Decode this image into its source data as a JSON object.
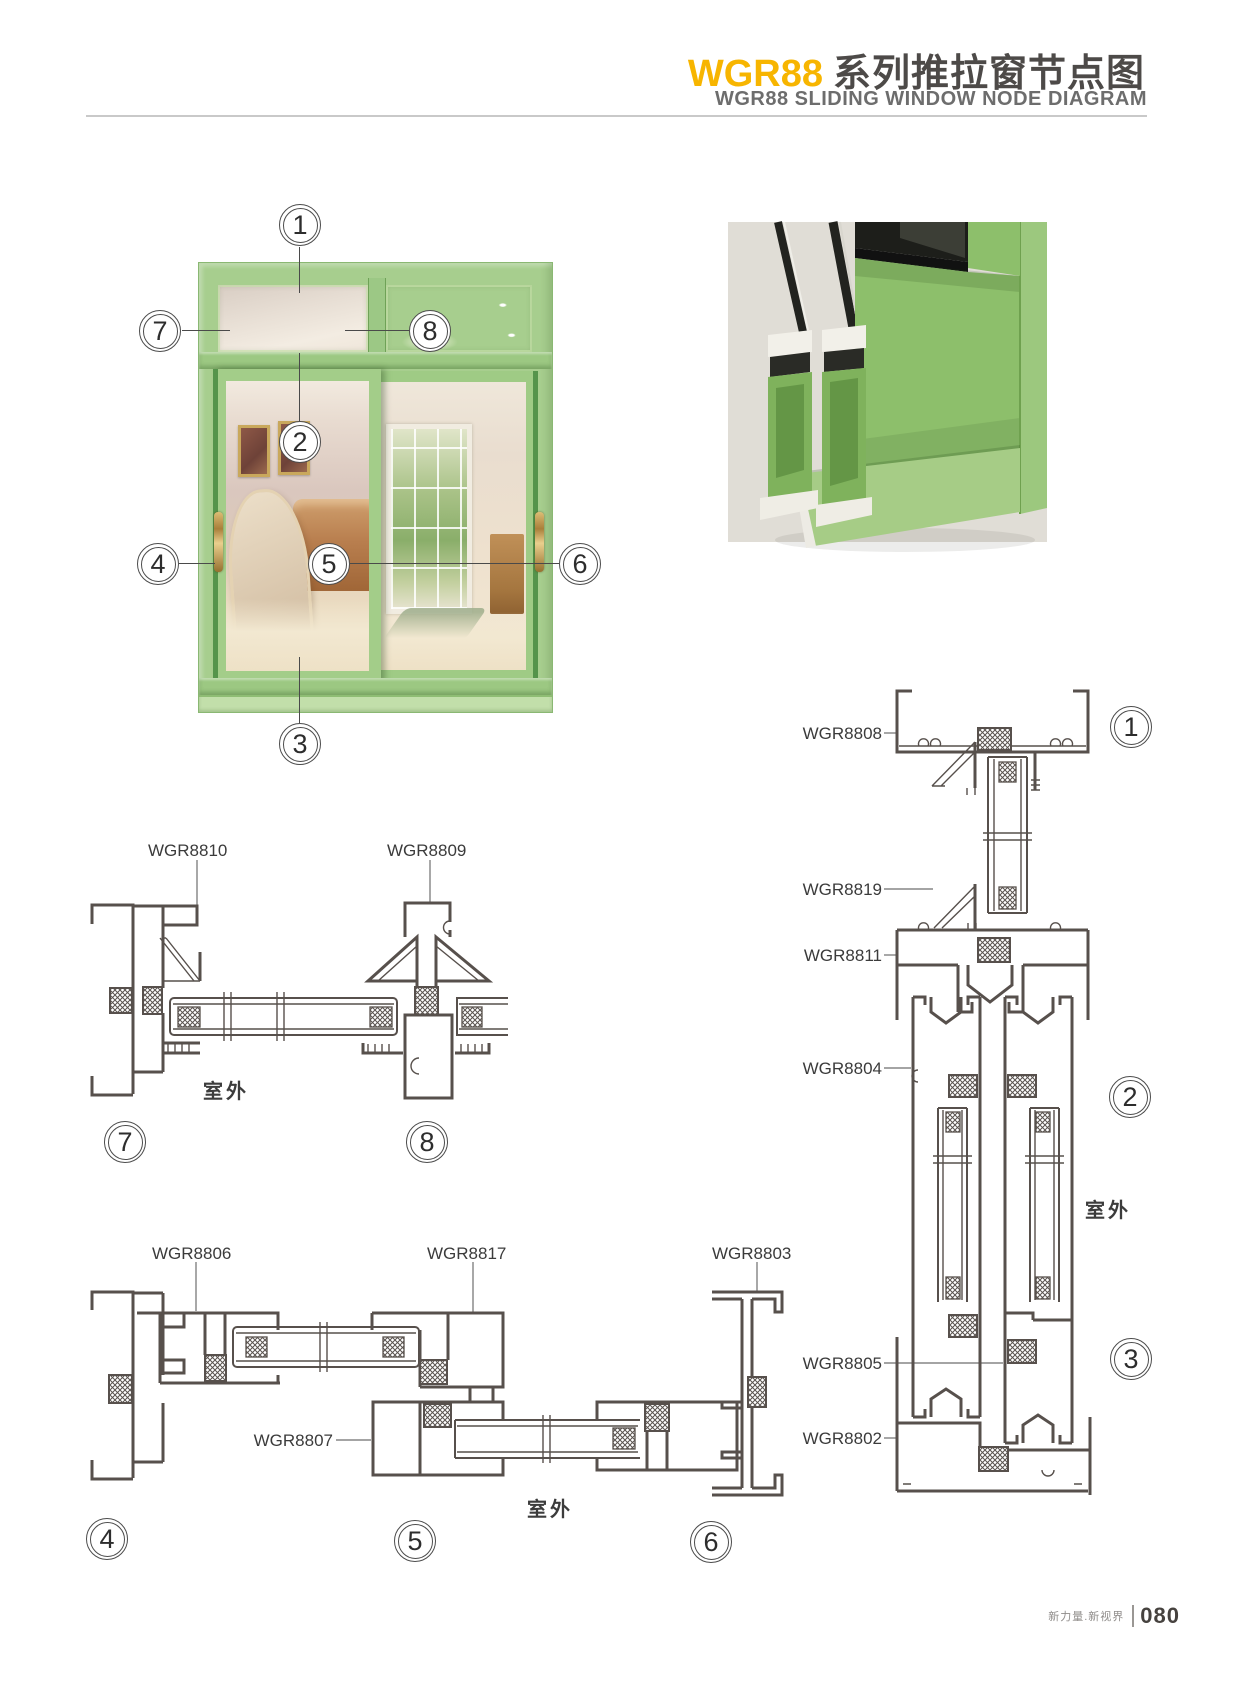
{
  "header": {
    "series": "WGR88",
    "title_zh": "系列推拉窗节点图",
    "subtitle": "WGR88 SLIDING WINDOW NODE DIAGRAM"
  },
  "window_figure": {
    "callouts": {
      "c1": "1",
      "c2": "2",
      "c3": "3",
      "c4": "4",
      "c5": "5",
      "c6": "6",
      "c7": "7",
      "c8": "8"
    }
  },
  "sections": {
    "s78": {
      "labels": {
        "l8810": "WGR8810",
        "l8809": "WGR8809"
      },
      "outdoor": "室外",
      "callouts": {
        "c7": "7",
        "c8": "8"
      }
    },
    "s456": {
      "labels": {
        "l8806": "WGR8806",
        "l8817": "WGR8817",
        "l8803": "WGR8803",
        "l8807": "WGR8807"
      },
      "outdoor": "室外",
      "callouts": {
        "c4": "4",
        "c5": "5",
        "c6": "6"
      }
    },
    "s123": {
      "labels": {
        "l8808": "WGR8808",
        "l8819": "WGR8819",
        "l8811": "WGR8811",
        "l8804": "WGR8804",
        "l8805": "WGR8805",
        "l8802": "WGR8802"
      },
      "outdoor": "室外",
      "callouts": {
        "c1": "1",
        "c2": "2",
        "c3": "3"
      }
    }
  },
  "footer": {
    "tagline": "新力量.新视界",
    "page_number": "080"
  },
  "colors": {
    "accent_yellow": "#F7B500",
    "frame_green": "#A7CE8E",
    "line_dark": "#57504C"
  }
}
